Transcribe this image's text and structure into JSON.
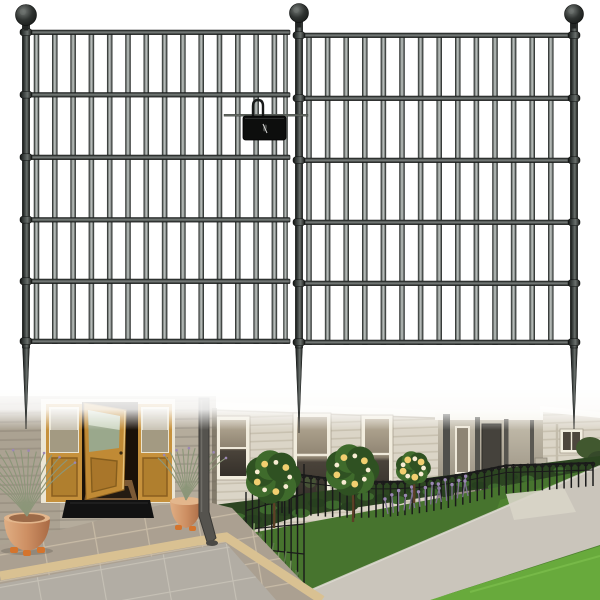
{
  "image": {
    "kind": "product-photo",
    "width": 600,
    "height": 600,
    "background": "#ffffff"
  },
  "colors": {
    "fence_black": "#1a1c1b",
    "bar_edge": "#232725",
    "photo_base": "#efece3",
    "wall_left": "#b5ac9c",
    "wall_right": "#dbd5c7",
    "fascia_white": "#f7f5ee",
    "door_wood": "#c6913c",
    "door_wood_dark": "#a9762a",
    "interior_dark": "#1a1108",
    "doormat": "#121212",
    "terracotta": "#cd8f63",
    "pot_feet": "#d4742d",
    "stem_green": "#8c9679",
    "lavender_purple": "#9b87b5",
    "tile_upper": "#aba091",
    "tile_lower": "#b2ada4",
    "step_stone": "#d9c192",
    "downspout": "#55534e",
    "soil": "#2c4521",
    "lawn_dark": "#47742e",
    "lawn_bright": "#68aa3c",
    "path": "#cac5bb",
    "rose_yellow": "#f2cf70",
    "rose_cream": "#f8ecd2",
    "canopy_green": "#3f6b2c",
    "canopy_green_dark": "#2f5122",
    "border_fence_black": "#1a1a1a"
  },
  "product": {
    "finish": "black-metal-garden-fence",
    "panel_count": 2,
    "rail_count": 6,
    "bar_count_per_panel": 14,
    "panels": [
      {
        "id": "fence-panel-left",
        "rail_x1": 26,
        "rail_x2": 290,
        "rail_ys": [
          30,
          92.5,
          155,
          217.5,
          279,
          339
        ],
        "bar_x_start": 36.5,
        "bar_spacing": 18.3,
        "bar_count": 14,
        "edge_bar_x": 285.5,
        "posts": [
          {
            "cx": 26,
            "ball_cy": 15,
            "ball_r": 10.5,
            "spike_tip_y": 429
          }
        ]
      },
      {
        "id": "fence-panel-right",
        "rail_x1": 299,
        "rail_x2": 574,
        "rail_ys": [
          33,
          96,
          158,
          220,
          281,
          340
        ],
        "bar_x_start": 309,
        "bar_spacing": 18.6,
        "bar_count": 14,
        "posts": [
          {
            "cx": 299,
            "ball_cy": 13,
            "ball_r": 9.5,
            "spike_tip_y": 433
          },
          {
            "cx": 574,
            "ball_cy": 14,
            "ball_r": 9.5,
            "spike_tip_y": 429
          }
        ]
      }
    ],
    "connector": {
      "x": 243,
      "y": 116,
      "width": 43,
      "height": 24,
      "wire_x1": 224,
      "wire_x2": 308,
      "wire_y": 114.2
    }
  },
  "photo": {
    "border_fence": {
      "picket_count": 44,
      "x1": 282,
      "x2": 593,
      "top_y1": 471,
      "top_y2": 462,
      "len1": 42,
      "len2": 24,
      "sag": 13
    },
    "return_mesh": {
      "x1": 246,
      "x2": 304,
      "y_top1": 492,
      "y_top2": 464,
      "y_bot1": 574,
      "y_bot2": 596,
      "cols": 10,
      "rows": 4
    },
    "rose_trees": [
      {
        "cx": 273,
        "cy": 477,
        "r": 27,
        "trunk_base": 528
      },
      {
        "cx": 352,
        "cy": 470,
        "r": 26,
        "trunk_base": 522
      },
      {
        "cx": 413,
        "cy": 468,
        "r": 17,
        "trunk_base": 503
      }
    ],
    "pot_plants": [
      {
        "cx": 27,
        "cy": 516,
        "n": 16,
        "spread": 58,
        "h": 66,
        "lean": -10
      },
      {
        "cx": 186,
        "cy": 500,
        "n": 12,
        "spread": 34,
        "h": 52,
        "lean": 6
      }
    ],
    "bed_clumps": {
      "n": 24,
      "x1": 220,
      "x2": 592,
      "y1": 520,
      "y2": 470
    },
    "bed_lavender": {
      "n": 16,
      "x1": 388,
      "x2": 468,
      "y1": 514,
      "y2": 496
    },
    "rosemary": {
      "n": 18,
      "x1": 246,
      "x2": 298,
      "y1": 545,
      "y2": 598
    }
  }
}
